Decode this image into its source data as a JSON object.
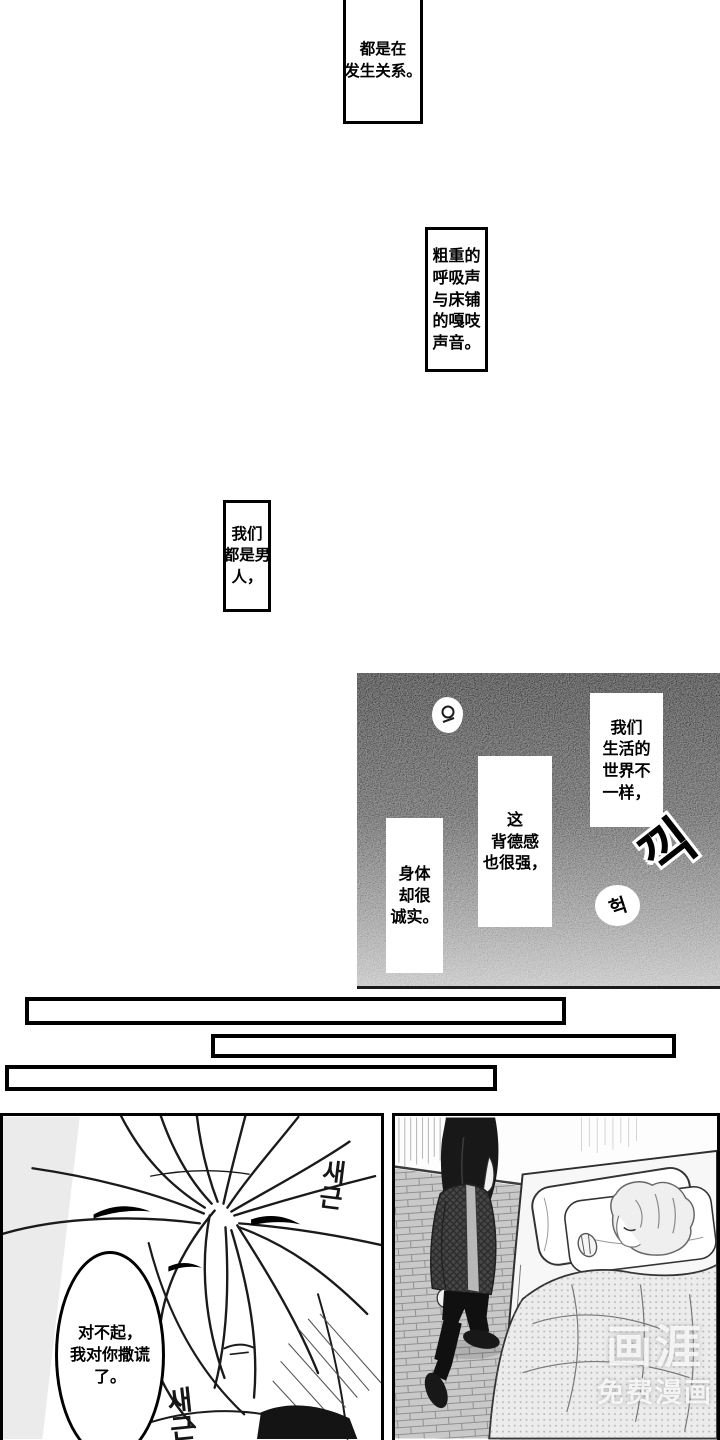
{
  "captions": {
    "c1": {
      "text": "都是在\n发生关系。"
    },
    "c2": {
      "text": "粗重的\n呼吸声\n与床铺\n的嘎吱\n声音。"
    },
    "c3": {
      "text": "我们\n都是男\n人，"
    },
    "c4": {
      "text": "我们\n生活的\n世界不\n一样，"
    },
    "c5": {
      "text": "这\n背德感\n也很强，"
    },
    "c6": {
      "text": "身体\n却很\n诚实。"
    }
  },
  "speech": {
    "apology": "对不起，\n我对你撒谎\n了。"
  },
  "sfx": {
    "kkik": "끽",
    "heok": "헉",
    "saegeun": "새\n근"
  },
  "watermark": {
    "logo": "画涯",
    "tagline": "免费漫画"
  },
  "colors": {
    "panel_dark_top": "#060606",
    "panel_dark_bottom": "#aeaeae",
    "ink": "#000000",
    "paper": "#ffffff"
  }
}
